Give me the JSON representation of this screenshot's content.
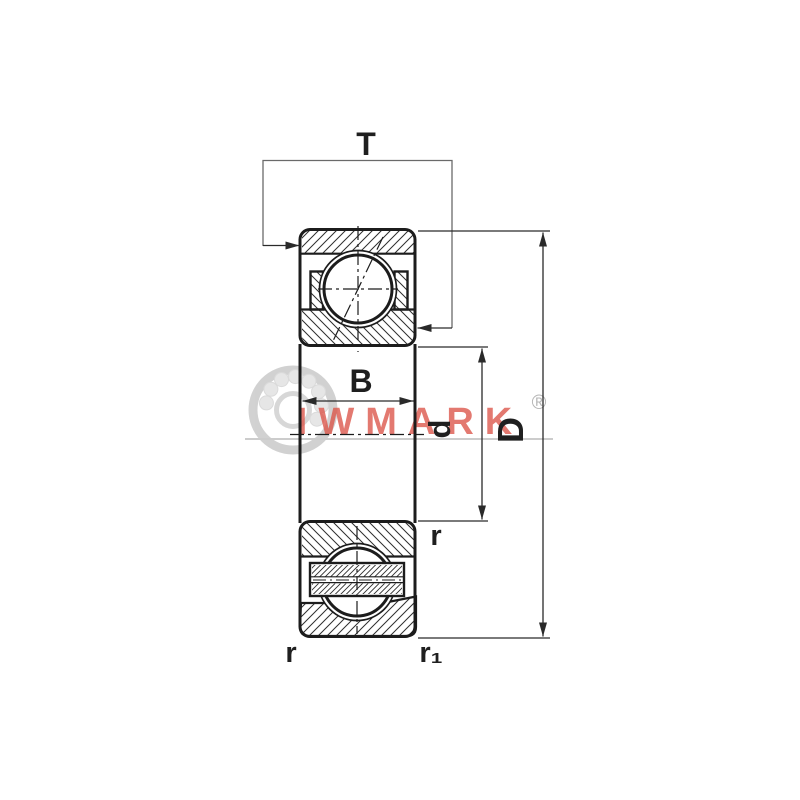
{
  "labels": {
    "total_width": "T",
    "inner_ring_width": "B",
    "bore_diameter": "d",
    "outer_diameter": "D",
    "fillet_radius": "r",
    "fillet_radius_1": "r₁"
  },
  "watermark": {
    "brand": "IWMARK",
    "registered_mark": "®"
  },
  "colors": {
    "line": "#1c1c1c",
    "dim_line": "#4a4a4a",
    "bracket_line": "#6a6a6a",
    "hatch": "#2e2e2e",
    "watermark_red": "#dc5448",
    "watermark_gray": "#b5b5b5",
    "underline_gray": "#cccccc"
  }
}
